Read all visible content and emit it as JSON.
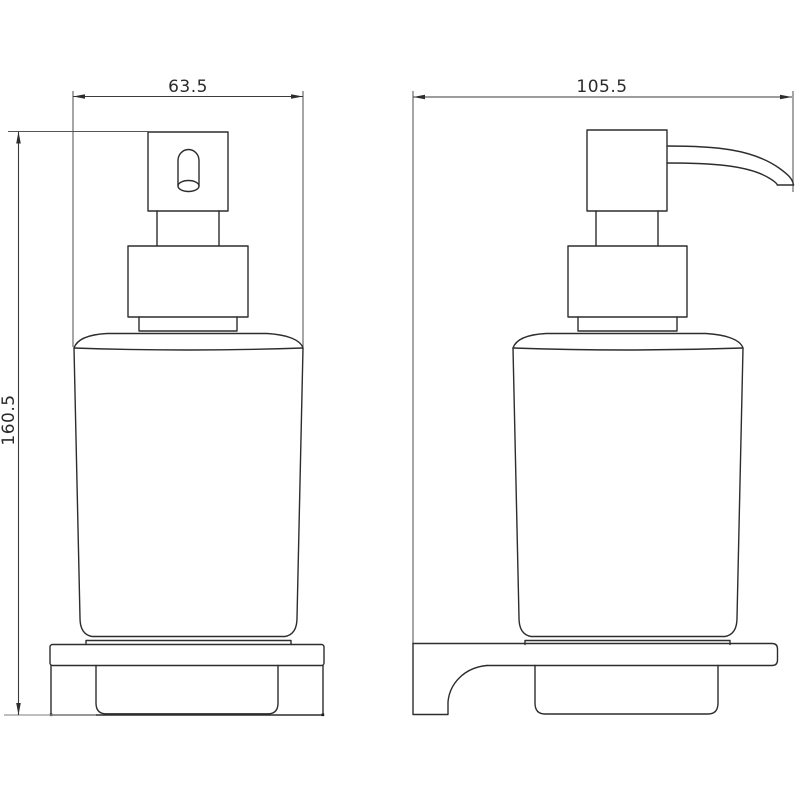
{
  "drawing": {
    "type": "technical-dimension-drawing",
    "subject": "wall-mounted soap dispenser, front and side orthographic views",
    "colors": {
      "background": "#ffffff",
      "object_line": "#2d2d2d",
      "dimension_line": "#3a3a3a",
      "extension_line_gray": "#999999",
      "text": "#2b2b2b"
    },
    "dimensions": {
      "front_width": {
        "value": "63.5",
        "orientation": "horizontal"
      },
      "side_depth": {
        "value": "105.5",
        "orientation": "horizontal"
      },
      "total_height": {
        "value": "160.5",
        "orientation": "vertical"
      }
    }
  }
}
